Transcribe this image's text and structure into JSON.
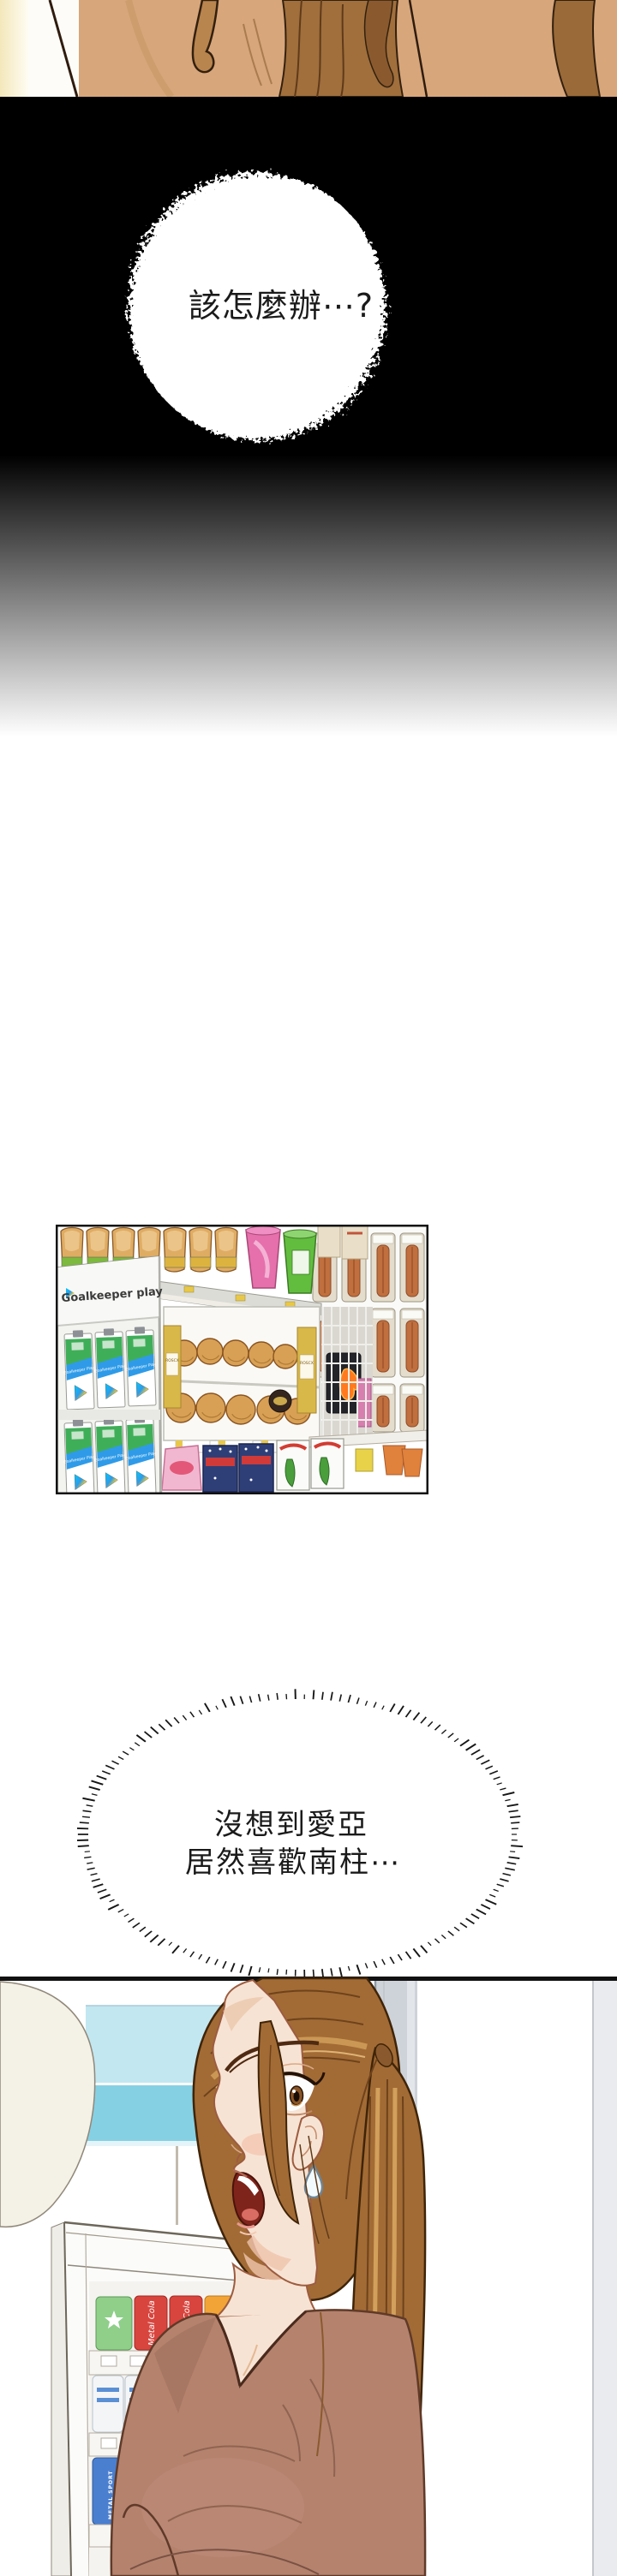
{
  "comic": {
    "bubble1": {
      "text": "該怎麼辦⋯?"
    },
    "bubble2": {
      "line1": "沒想到愛亞",
      "line2": "居然喜歡南柱⋯"
    },
    "store_panel": {
      "sign": "Goalkeeper play",
      "gift_card_label": "Goalkeeper Play",
      "pastry_box_label": "ROSCX"
    },
    "cooler": {
      "can_cola": "Metal Cola",
      "can_orange": "Méta",
      "can_green": "Metall",
      "can_sport": "METAL SPORT"
    },
    "colors": {
      "background": "#ffffff",
      "black_zone": "#000000",
      "hair": "#a26b35",
      "hair_highlight": "#cf9a55",
      "skin": "#f7e3d3",
      "shirt": "#b5826e",
      "window_blue": "#86d0e3",
      "window_blue_light": "#c2e7f1",
      "pillar_gray": "#ced3d9",
      "card_green": "#3fae58",
      "card_blue": "#2f9be8",
      "can_red": "#d8453e",
      "can_blue": "#4a7fd0",
      "can_green": "#66bd59",
      "can_orange": "#f2a437"
    }
  }
}
